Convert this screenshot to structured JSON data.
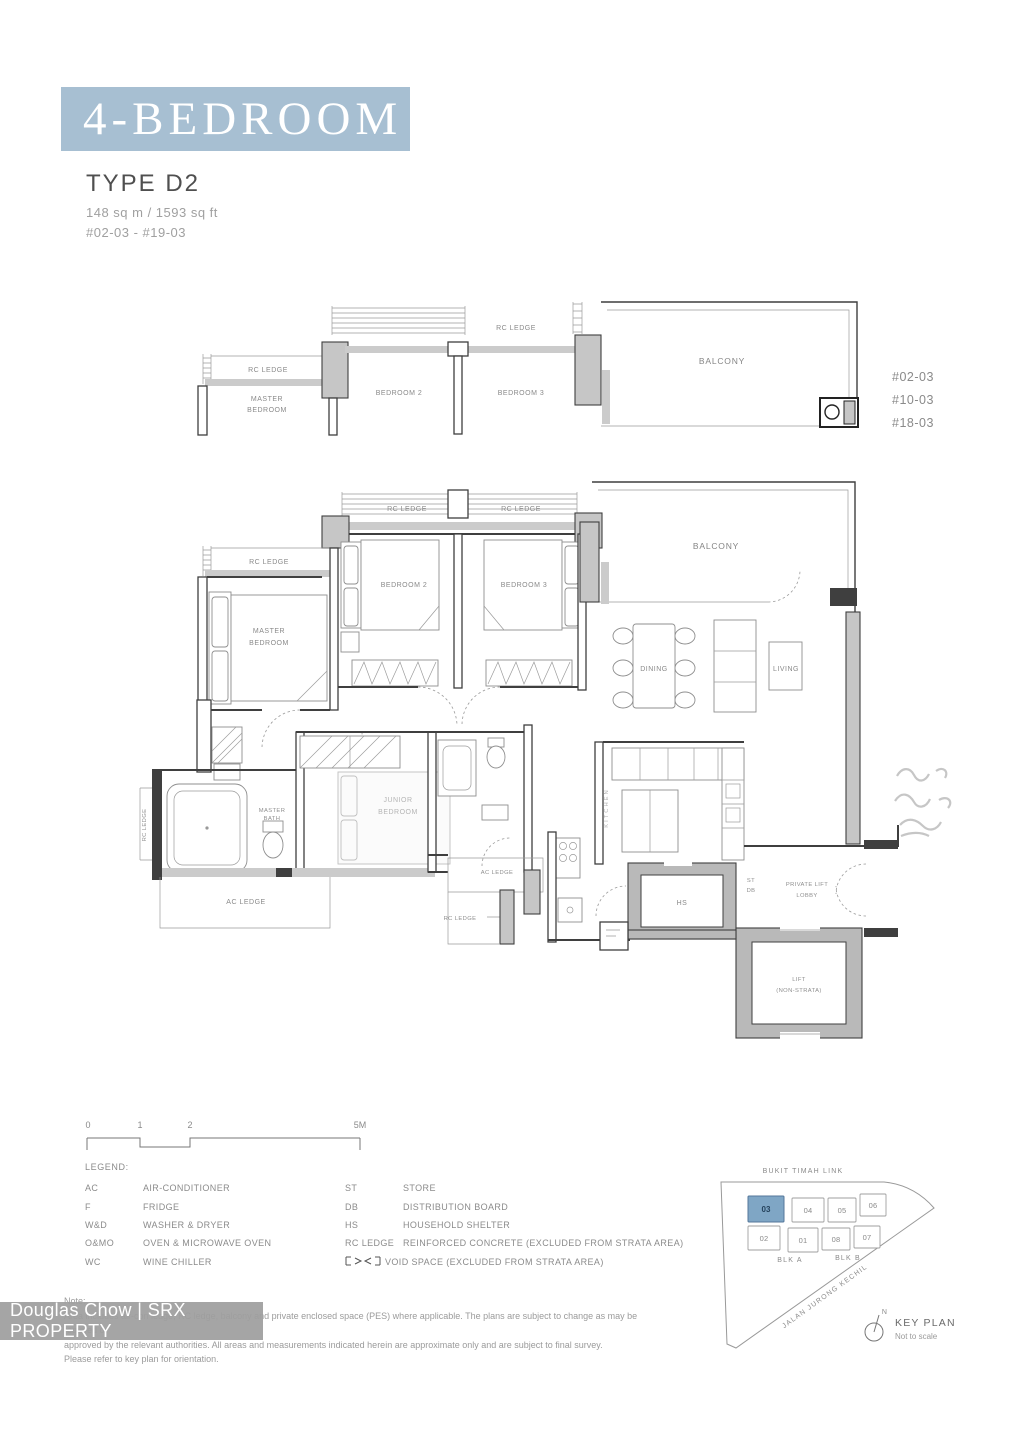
{
  "colors": {
    "banner-bg": "#a7bfd2",
    "banner-text": "#ffffff",
    "highlight-block": "#7fa6c5",
    "plan-line": "#3f3f3f",
    "label-gray": "#8a8a8a"
  },
  "banner": {
    "title": "4-BEDROOM"
  },
  "unit": {
    "type": "TYPE D2",
    "area": "148 sq m / 1593 sq ft",
    "stack_range": "#02-03 - #19-03"
  },
  "plan": {
    "labels": {
      "rc_ledge": "RC LEDGE",
      "ac_ledge": "AC LEDGE",
      "master_1": "MASTER",
      "master_2": "BEDROOM",
      "bedroom2": "BEDROOM 2",
      "bedroom3": "BEDROOM 3",
      "balcony": "BALCONY",
      "dining": "DINING",
      "living": "LIVING",
      "junior_1": "JUNIOR",
      "junior_2": "BEDROOM",
      "master_bath_1": "MASTER",
      "master_bath_2": "BATH",
      "kitchen": "KITCHEN",
      "hs": "HS",
      "st": "ST",
      "db": "DB",
      "lobby_1": "PRIVATE LIFT",
      "lobby_2": "LOBBY",
      "lift_1": "LIFT",
      "lift_2": "(NON-STRATA)"
    },
    "stack_list": [
      "#02-03",
      "#10-03",
      "#18-03"
    ]
  },
  "scalebar": {
    "t0": "0",
    "t1": "1",
    "t2": "2",
    "t5": "5M"
  },
  "legend": {
    "title": "LEGEND:",
    "left": [
      {
        "abbr": "AC",
        "desc": "AIR-CONDITIONER"
      },
      {
        "abbr": "F",
        "desc": "FRIDGE"
      },
      {
        "abbr": "W&D",
        "desc": "WASHER & DRYER"
      },
      {
        "abbr": "O&MO",
        "desc": "OVEN & MICROWAVE OVEN"
      },
      {
        "abbr": "WC",
        "desc": "WINE CHILLER"
      }
    ],
    "right": [
      {
        "abbr": "ST",
        "desc": "STORE"
      },
      {
        "abbr": "DB",
        "desc": "DISTRIBUTION BOARD"
      },
      {
        "abbr": "HS",
        "desc": "HOUSEHOLD SHELTER"
      },
      {
        "abbr": "RC LEDGE",
        "desc": "REINFORCED CONCRETE (EXCLUDED FROM STRATA AREA)"
      }
    ],
    "void_desc": "VOID SPACE (EXCLUDED FROM STRATA AREA)"
  },
  "keyplan": {
    "road_top": "BUKIT TIMAH LINK",
    "road_diagonal": "JALAN JURONG KECHIL",
    "blk_a": "BLK A",
    "blk_b": "BLK B",
    "blocks": [
      "03",
      "04",
      "05",
      "06",
      "02",
      "01",
      "08",
      "07"
    ],
    "highlighted_block": "03",
    "north": "N",
    "title": "KEY PLAN",
    "subtitle": "Not to scale"
  },
  "watermark": {
    "text": "Douglas Chow | SRX PROPERTY"
  },
  "note": {
    "heading": "Note:",
    "line1": "Area includes air-con ledge, RC ledge, balcony and private enclosed space (PES) where applicable. The plans are subject to change as may be required or",
    "line2": "approved by the relevant authorities. All areas and measurements indicated herein are approximate only and are subject to final survey.",
    "line3": "Please refer to key plan for orientation."
  }
}
